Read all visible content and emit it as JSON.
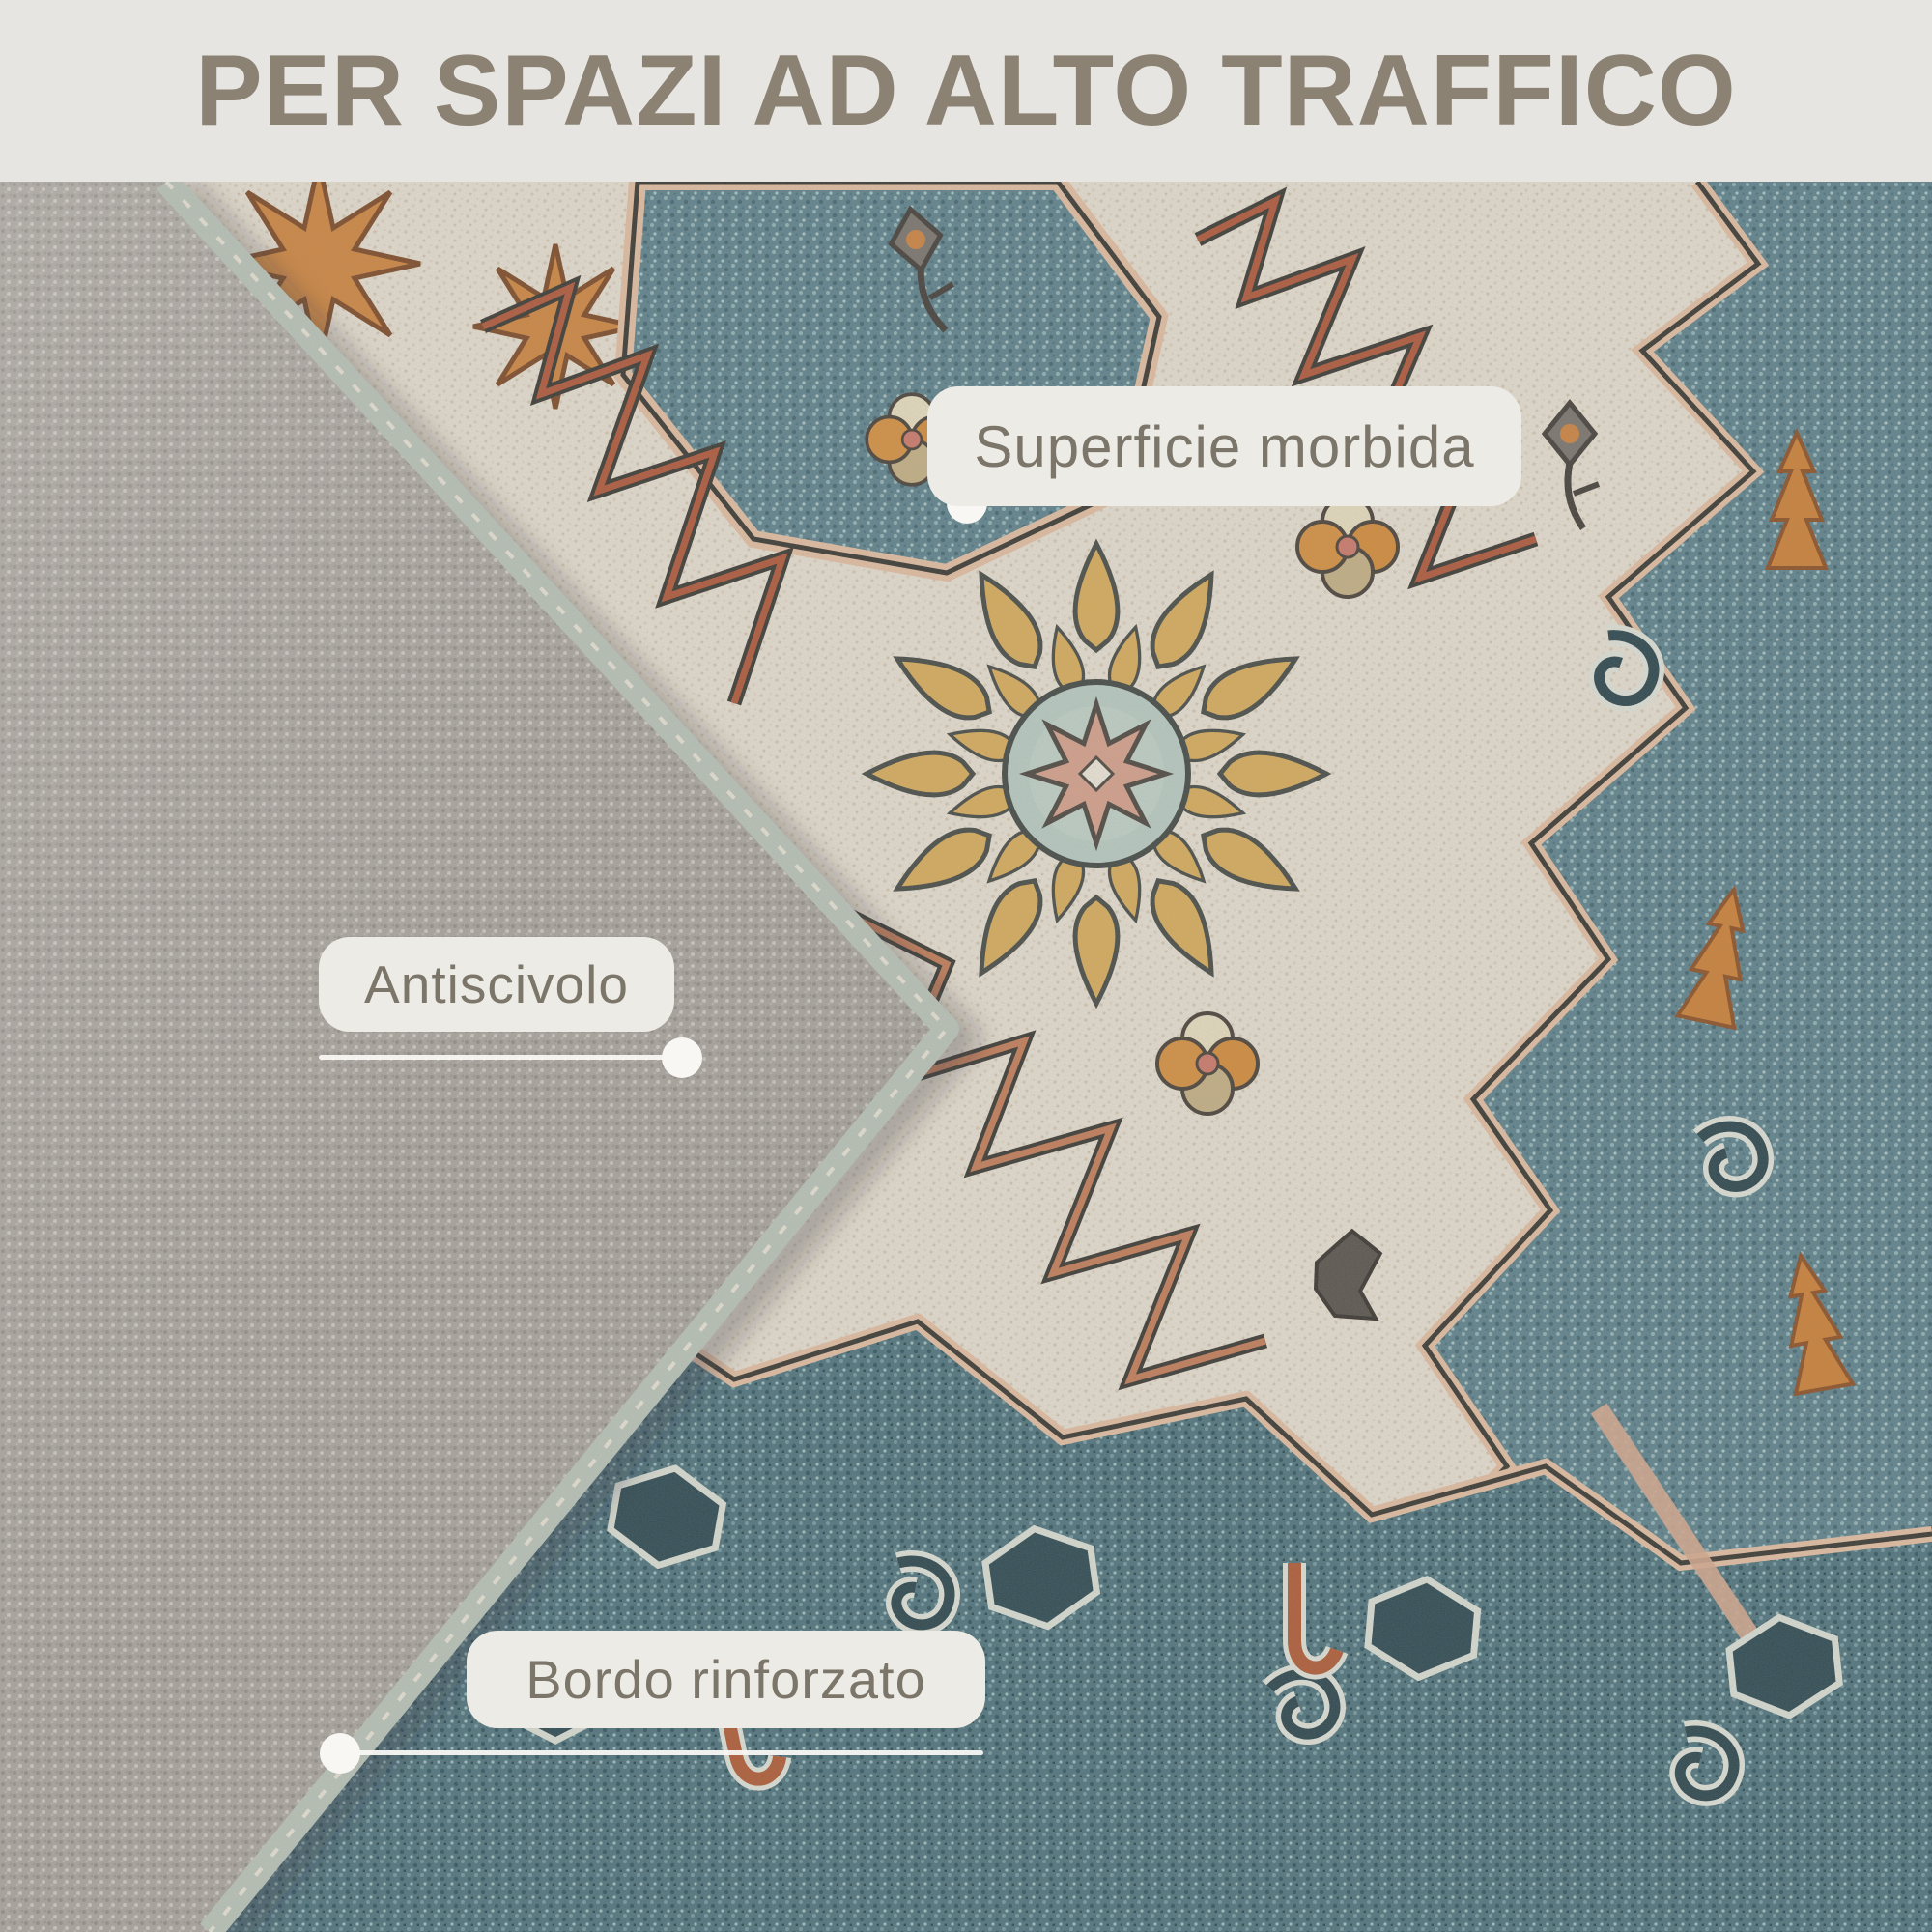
{
  "header": {
    "title": "PER SPAZI AD ALTO TRAFFICO"
  },
  "callouts": [
    {
      "id": "soft-surface",
      "label": "Superficie morbida"
    },
    {
      "id": "anti-slip",
      "label": "Antiscivolo"
    },
    {
      "id": "reinforced-edge",
      "label": "Bordo rinforzato"
    }
  ],
  "colors": {
    "header_bg": "#e7e5e1",
    "header_text": "#8b8273",
    "pill_bg": "#edebe5",
    "pill_text": "#7c766a",
    "connector": "#f8f7f3",
    "rug_cream": "#ebe4d7",
    "rug_teal": "#57808e",
    "rug_teal_dark": "#47707d",
    "rug_rust": "#b0562f",
    "rug_gold": "#d2a050",
    "rug_orange": "#d2843a",
    "backing_gray": "#a7a39e",
    "binding_sage": "#bac7bd"
  }
}
